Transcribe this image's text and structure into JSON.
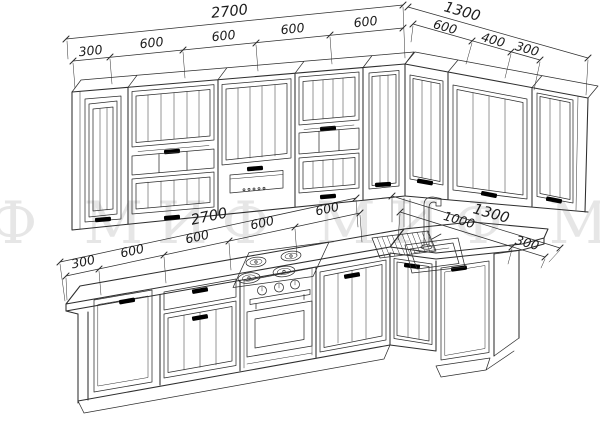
{
  "watermark": {
    "text": "МИФ МИФ МИФ МИФ"
  },
  "colors": {
    "line": "#2e2e2e",
    "background": "#ffffff",
    "watermark": "#d7d7d7",
    "dim_text": "#1c1c1c"
  },
  "dimensions": {
    "upper_left": {
      "total": "2700",
      "segments": [
        "300",
        "600",
        "600",
        "600",
        "600"
      ]
    },
    "upper_right": {
      "total": "1300",
      "segments": [
        "600",
        "400",
        "300"
      ]
    },
    "lower_left": {
      "total": "2700",
      "segments": [
        "300",
        "600",
        "600",
        "600",
        "600"
      ]
    },
    "lower_right": {
      "total": "1300",
      "segments": [
        "1000",
        "300"
      ]
    }
  }
}
